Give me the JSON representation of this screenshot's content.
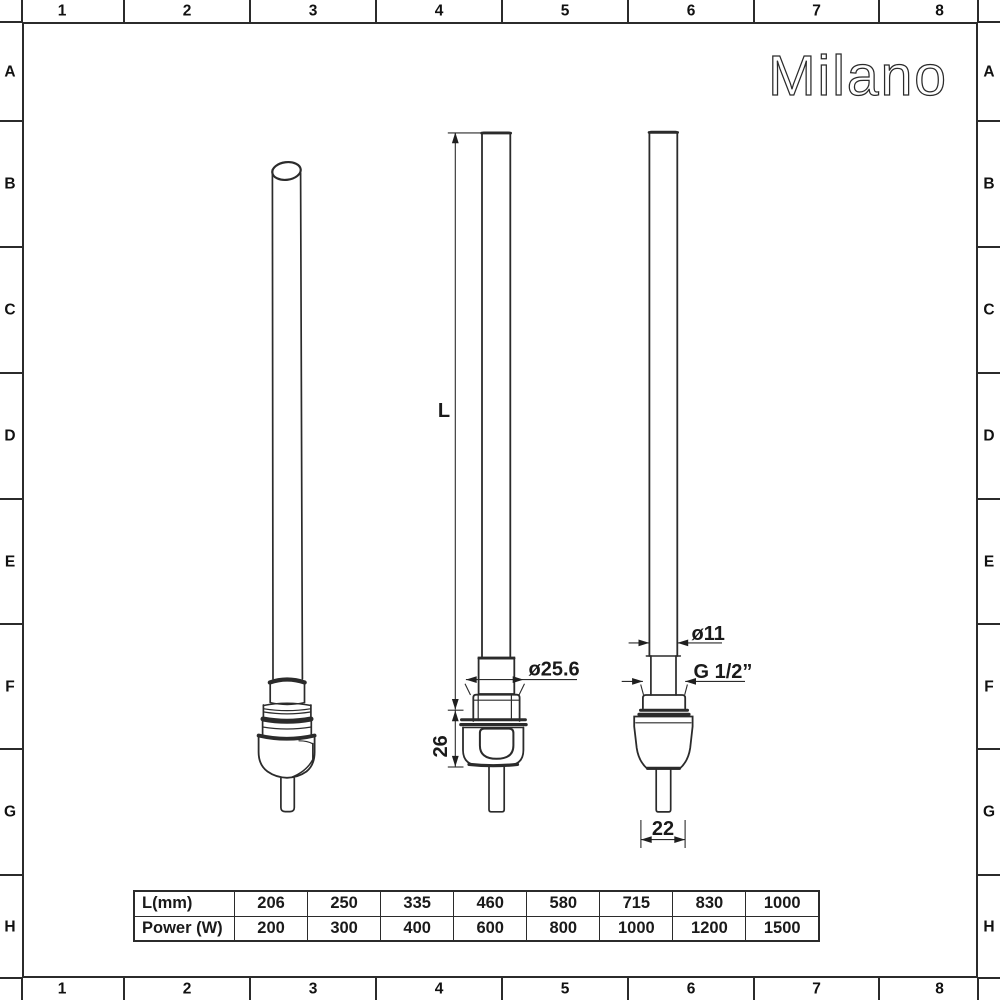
{
  "brand": "Milano",
  "grid": {
    "columns": [
      "1",
      "2",
      "3",
      "4",
      "5",
      "6",
      "7",
      "8"
    ],
    "rows": [
      "A",
      "B",
      "C",
      "D",
      "E",
      "F",
      "G",
      "H"
    ]
  },
  "drawing": {
    "front_view": {
      "length_label": "L",
      "body_height_label": "26",
      "nut_diameter_label": "ø25.6"
    },
    "side_view": {
      "tube_diameter_label": "ø11",
      "thread_label": "G 1/2”",
      "body_width_label": "22"
    }
  },
  "spec_table": {
    "rows": [
      {
        "label": "L(mm)",
        "values": [
          "206",
          "250",
          "335",
          "460",
          "580",
          "715",
          "830",
          "1000"
        ]
      },
      {
        "label": "Power (W)",
        "values": [
          "200",
          "300",
          "400",
          "600",
          "800",
          "1000",
          "1200",
          "1500"
        ]
      }
    ]
  },
  "colors": {
    "line": "#2b2b2b",
    "text": "#1a1a1a",
    "background": "#ffffff"
  }
}
